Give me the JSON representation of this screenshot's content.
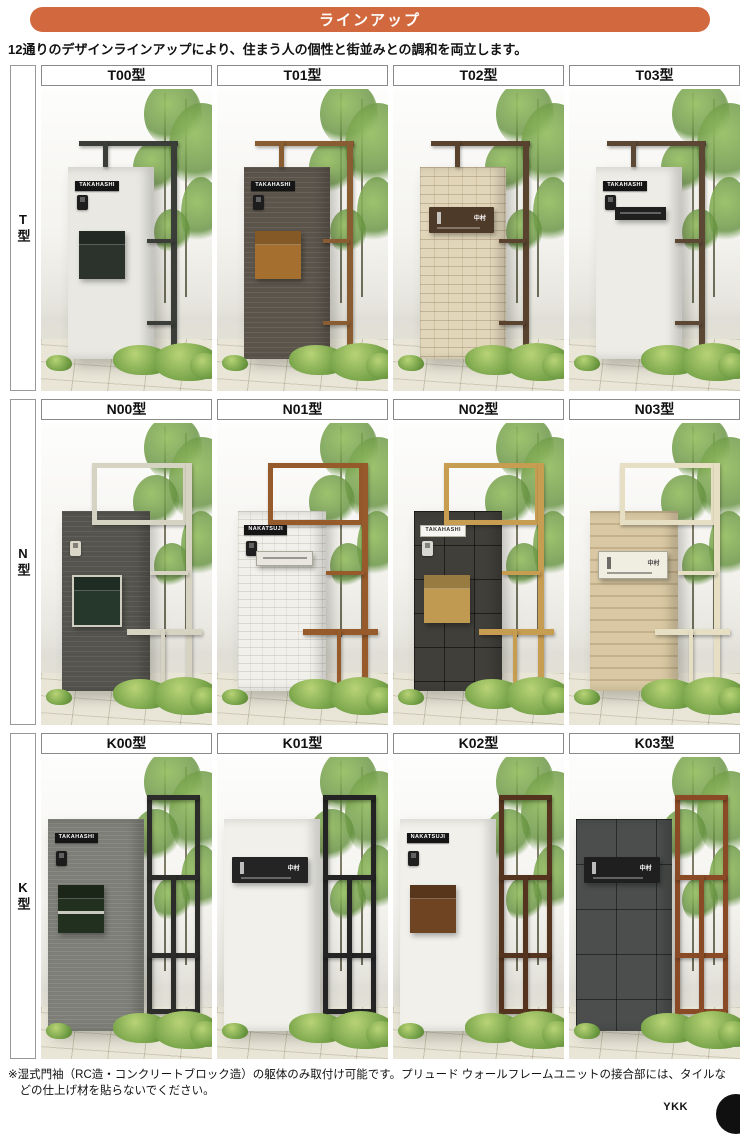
{
  "header": {
    "title": "ラインアップ",
    "accent_color": "#d2693e"
  },
  "intro": "12通りのデザインラインアップにより、住まう人の個性と街並みとの調和を両立します。",
  "rows": [
    {
      "label": "T型",
      "cells": [
        {
          "model": "T00型",
          "nameplate": "TAKAHASHI",
          "nameplate_style": "dark",
          "frame_style": "T",
          "frame_color": "#3b3d39",
          "wall_pattern": "plain-light",
          "unit": "box",
          "unit_color": "#2b332c",
          "intercom": "#1e1e1e"
        },
        {
          "model": "T01型",
          "nameplate": "TAKAHASHI",
          "nameplate_style": "dark",
          "frame_style": "T",
          "frame_color": "#8a5c32",
          "wall_pattern": "hstripe-brown",
          "unit": "box",
          "unit_color": "#a5702f",
          "intercom": "#1d1d1d"
        },
        {
          "model": "T02型",
          "nameplate": "中村",
          "nameplate_style": "dark",
          "frame_style": "T",
          "frame_color": "#59422e",
          "wall_pattern": "brick-beige",
          "unit": "hbar",
          "unit_color": "#4e3a29",
          "intercom": null
        },
        {
          "model": "T03型",
          "nameplate": "TAKAHASHI",
          "nameplate_style": "dark",
          "frame_style": "T",
          "frame_color": "#5c4734",
          "wall_pattern": "stucco-light",
          "unit": "slot",
          "unit_color": "#1f1f1f",
          "intercom": "#1e1e1e"
        }
      ]
    },
    {
      "label": "N型",
      "cells": [
        {
          "model": "N00型",
          "nameplate": null,
          "nameplate_style": "dark",
          "frame_style": "N",
          "frame_color": "#d7d3c2",
          "wall_pattern": "hstripe-gray",
          "unit": "box",
          "unit_color": "#26372c",
          "unit_trim": "#cfcdbf",
          "intercom": "#d9d6c8"
        },
        {
          "model": "N01型",
          "nameplate": "NAKATSUJI",
          "nameplate_style": "dark",
          "frame_style": "N",
          "frame_color": "#975a2b",
          "wall_pattern": "brick-white",
          "unit": "slot",
          "unit_color": "#e8e6de",
          "unit_variant": "light",
          "intercom": "#1f1f1f"
        },
        {
          "model": "N02型",
          "nameplate": "TAKAHASHI",
          "nameplate_style": "light",
          "frame_style": "N",
          "frame_color": "#c79d52",
          "wall_pattern": "tile-dark",
          "unit": "box",
          "unit_color": "#bf9a50",
          "intercom": "#d8d8d2"
        },
        {
          "model": "N03型",
          "nameplate": "中村",
          "nameplate_style": "light",
          "frame_style": "N",
          "frame_color": "#e6dfc4",
          "wall_pattern": "stripe-tan",
          "unit": "hbar",
          "unit_color": "#f0ede1",
          "unit_variant": "light",
          "intercom": null
        }
      ]
    },
    {
      "label": "K型",
      "cells": [
        {
          "model": "K00型",
          "nameplate": "TAKAHASHI",
          "nameplate_style": "dark",
          "frame_style": "K",
          "frame_color": "#2c2c2a",
          "wall_pattern": "hstripe-gray2",
          "unit": "box",
          "unit_color": "#22301f",
          "unit_stripe": "#c9c9c2",
          "intercom": "#1c1c1c"
        },
        {
          "model": "K01型",
          "nameplate": "中村",
          "nameplate_style": "dark",
          "frame_style": "K",
          "frame_color": "#242424",
          "wall_pattern": "stucco-white",
          "unit": "hbar",
          "unit_color": "#242424",
          "intercom": null
        },
        {
          "model": "K02型",
          "nameplate": "NAKATSUJI",
          "nameplate_style": "dark",
          "frame_style": "K",
          "frame_color": "#54341f",
          "wall_pattern": "stucco-white",
          "unit": "box",
          "unit_color": "#6e4423",
          "intercom": "#1f1f1f"
        },
        {
          "model": "K03型",
          "nameplate": "中村",
          "nameplate_style": "dark",
          "frame_style": "K",
          "frame_color": "#8a4a26",
          "wall_pattern": "slate-dark",
          "unit": "hbar",
          "unit_color": "#1f1f1f",
          "intercom": null
        }
      ]
    }
  ],
  "footnote": "※湿式門袖（RC造・コンクリートブロック造）の躯体のみ取付け可能です。プリュード ウォールフレームユニットの接合部には、タイルなどの仕上げ材を貼らないでください。",
  "brand": "YKK"
}
